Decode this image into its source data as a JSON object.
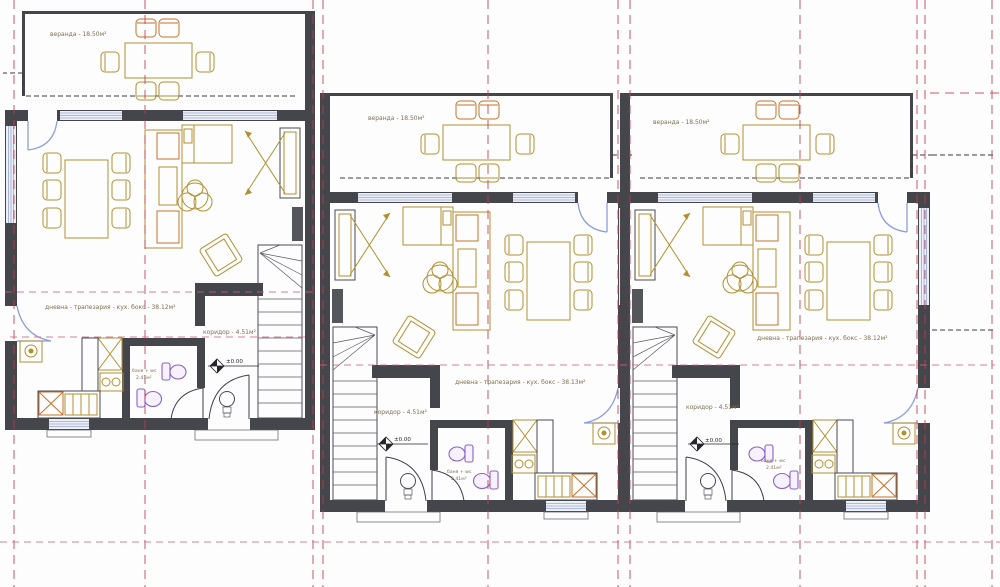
{
  "plan": {
    "type": "architectural floor plan - ground floor of three row-house units",
    "colors": {
      "walls": "#45454c",
      "furniture": "#b3902f",
      "furniture_accent": "#c8742c",
      "doors_blue": "#8b9fe0",
      "windows": "#96a5d6",
      "sanitary_purple": "#8a63c9",
      "grid_red": "#c23b4b",
      "grid_pink": "#d06080",
      "label_text": "#7d6f52"
    },
    "units": [
      {
        "veranda": "веранда - 18.50м²",
        "living": "дневна - трапезария - кух. бокс - 38.12м²",
        "corridor": "коридор - 4.51м²",
        "bath_line1": "баня + wc",
        "bath_line2": "2.41м²",
        "level": "±0.00"
      },
      {
        "veranda": "веранда - 18.50м²",
        "living": "дневна - трапезария - кух. бокс - 38.13м²",
        "corridor": "коридор - 4.51м²",
        "bath_line1": "баня + wc",
        "bath_line2": "2.41м²",
        "level": "±0.00"
      },
      {
        "veranda": "веранда - 18.50м²",
        "living": "дневна - трапезария - кух. бокс - 38.12м²",
        "corridor": "коридор - 4.51м²",
        "bath_line1": "баня + wc",
        "bath_line2": "2.41м²",
        "level": "±0.00"
      }
    ]
  }
}
